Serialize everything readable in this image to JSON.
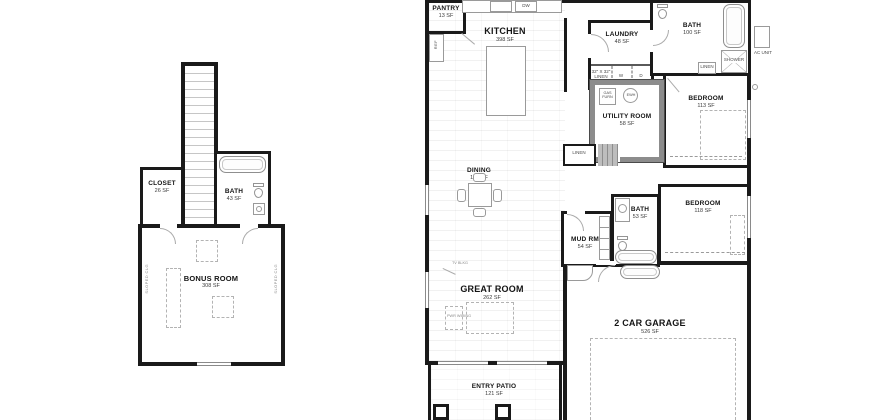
{
  "upper_plan": {
    "closet": {
      "name": "CLOSET",
      "sf": "26 SF"
    },
    "bath": {
      "name": "BATH",
      "sf": "43 SF"
    },
    "bonus_room": {
      "name": "BONUS ROOM",
      "sf": "308 SF"
    },
    "sloped_note": "SLOPED CLG"
  },
  "main_plan": {
    "pantry": {
      "name": "PANTRY",
      "sf": "13 SF"
    },
    "kitchen": {
      "name": "KITCHEN",
      "sf": "398 SF"
    },
    "laundry": {
      "name": "LAUNDRY",
      "sf": "48 SF"
    },
    "bath_hall": {
      "name": "BATH",
      "sf": "100 SF"
    },
    "utility_room": {
      "name": "UTILITY ROOM",
      "sf": "58 SF"
    },
    "bedroom_rear": {
      "name": "BEDROOM",
      "sf": "113 SF"
    },
    "dining": {
      "name": "DINING",
      "sf": "155 SF"
    },
    "mud_room": {
      "name": "MUD RM",
      "sf": "54 SF"
    },
    "bath_front": {
      "name": "BATH",
      "sf": "53 SF"
    },
    "bedroom_front": {
      "name": "BEDROOM",
      "sf": "118 SF"
    },
    "great_room": {
      "name": "GREAT ROOM",
      "sf": "262 SF"
    },
    "garage": {
      "name": "2 CAR GARAGE",
      "sf": "526 SF"
    },
    "entry_patio": {
      "name": "ENTRY PATIO",
      "sf": "121 SF"
    }
  },
  "fixtures": {
    "ref": "REF",
    "dw": "DW",
    "linen": "LINEN",
    "linen_size": "32\" X 32\" LINEN",
    "washer": "W",
    "dryer": "D",
    "gas_furnace": "GAS FURN",
    "water_heater": "EWH",
    "shower": "SHOWER",
    "ac_unit": "AC UNIT",
    "tv_note": "TV BLKG",
    "power_note": "PWR WIRING"
  },
  "colors": {
    "wall": "#1a1a1a",
    "fixture_line": "#9a9a9a",
    "highlight_wall": "#8c8c8c",
    "background": "#ffffff"
  }
}
